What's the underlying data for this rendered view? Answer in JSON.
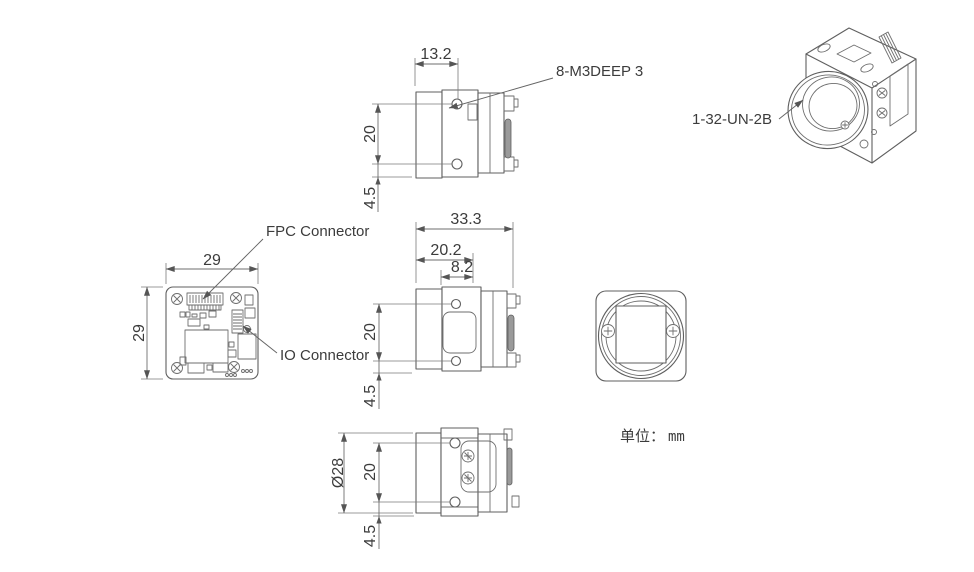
{
  "page": {
    "background": "#ffffff",
    "line_color": "#5f5f5f",
    "dim_color": "#6e6e6e",
    "text_color": "#3c3c3c",
    "unit_note": {
      "label": "单位：",
      "value": "mm"
    }
  },
  "views": {
    "top_side_view": {
      "dims": {
        "hole_offset_front": "13.2",
        "hole_spacing": "20",
        "hole_edge_offset": "4.5"
      },
      "callouts": {
        "thread_holes": "8-M3DEEP 3"
      }
    },
    "perspective_view": {
      "callouts": {
        "lens_mount_thread": "1-32-UN-2B"
      }
    },
    "pcb_back_view": {
      "dims": {
        "width": "29",
        "height": "29"
      },
      "callouts": {
        "fpc": "FPC Connector",
        "io": "IO Connector"
      }
    },
    "side_section_view": {
      "dims": {
        "depth_total": "33.3",
        "depth_body": "20.2",
        "depth_front": "8.2",
        "hole_spacing": "20",
        "hole_edge_offset": "4.5"
      }
    },
    "bottom_view": {
      "dims": {
        "lens_diameter": "Ø28",
        "hole_spacing": "20",
        "hole_edge_offset": "4.5"
      }
    }
  }
}
